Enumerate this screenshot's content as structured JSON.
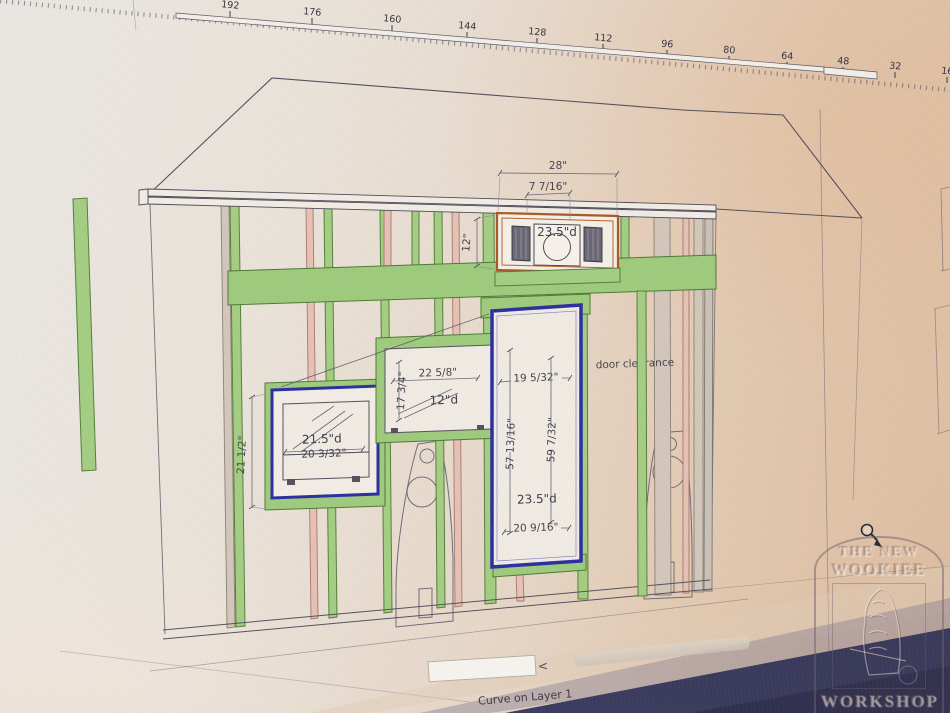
{
  "ruler": {
    "labels": [
      "192",
      "176",
      "160",
      "144",
      "128",
      "112",
      "96",
      "80",
      "64",
      "48",
      "32",
      "16"
    ]
  },
  "statusbar": {
    "status_text": "Curve on Layer 1",
    "scroll_left": "<"
  },
  "dims": {
    "top_box_width": "28\"",
    "top_box_offset": "7 7/16\"",
    "top_box_height": "12\"",
    "top_box_depth": "23.5\"d",
    "tv_height": "21 1/2\"",
    "tv_depth": "21.5\"d",
    "tv_width": "20 3/32\"",
    "center_width": "22 5/8\"",
    "center_height": "17 3/4\"",
    "center_depth": "12\"d",
    "win_top_width": "19 5/32\"",
    "win_left_height": "57 13/16\"",
    "win_right_height": "59 7/32\"",
    "win_depth": "23.5\"d",
    "win_bottom_width": "20 9/16\"",
    "door_clearance": "door clearance"
  },
  "watermark": {
    "line1": "THE NEW",
    "line2": "WOOKIEE",
    "line3": "WORKSHOP"
  },
  "colors": {
    "stud_green": "#a4ce83",
    "stud_pink": "#e6c1b5",
    "stud_tan": "#d2c7ba",
    "frame_blue": "#2b2fa0",
    "frame_orange": "#a85a28",
    "header_green": "#9ecb7d"
  }
}
